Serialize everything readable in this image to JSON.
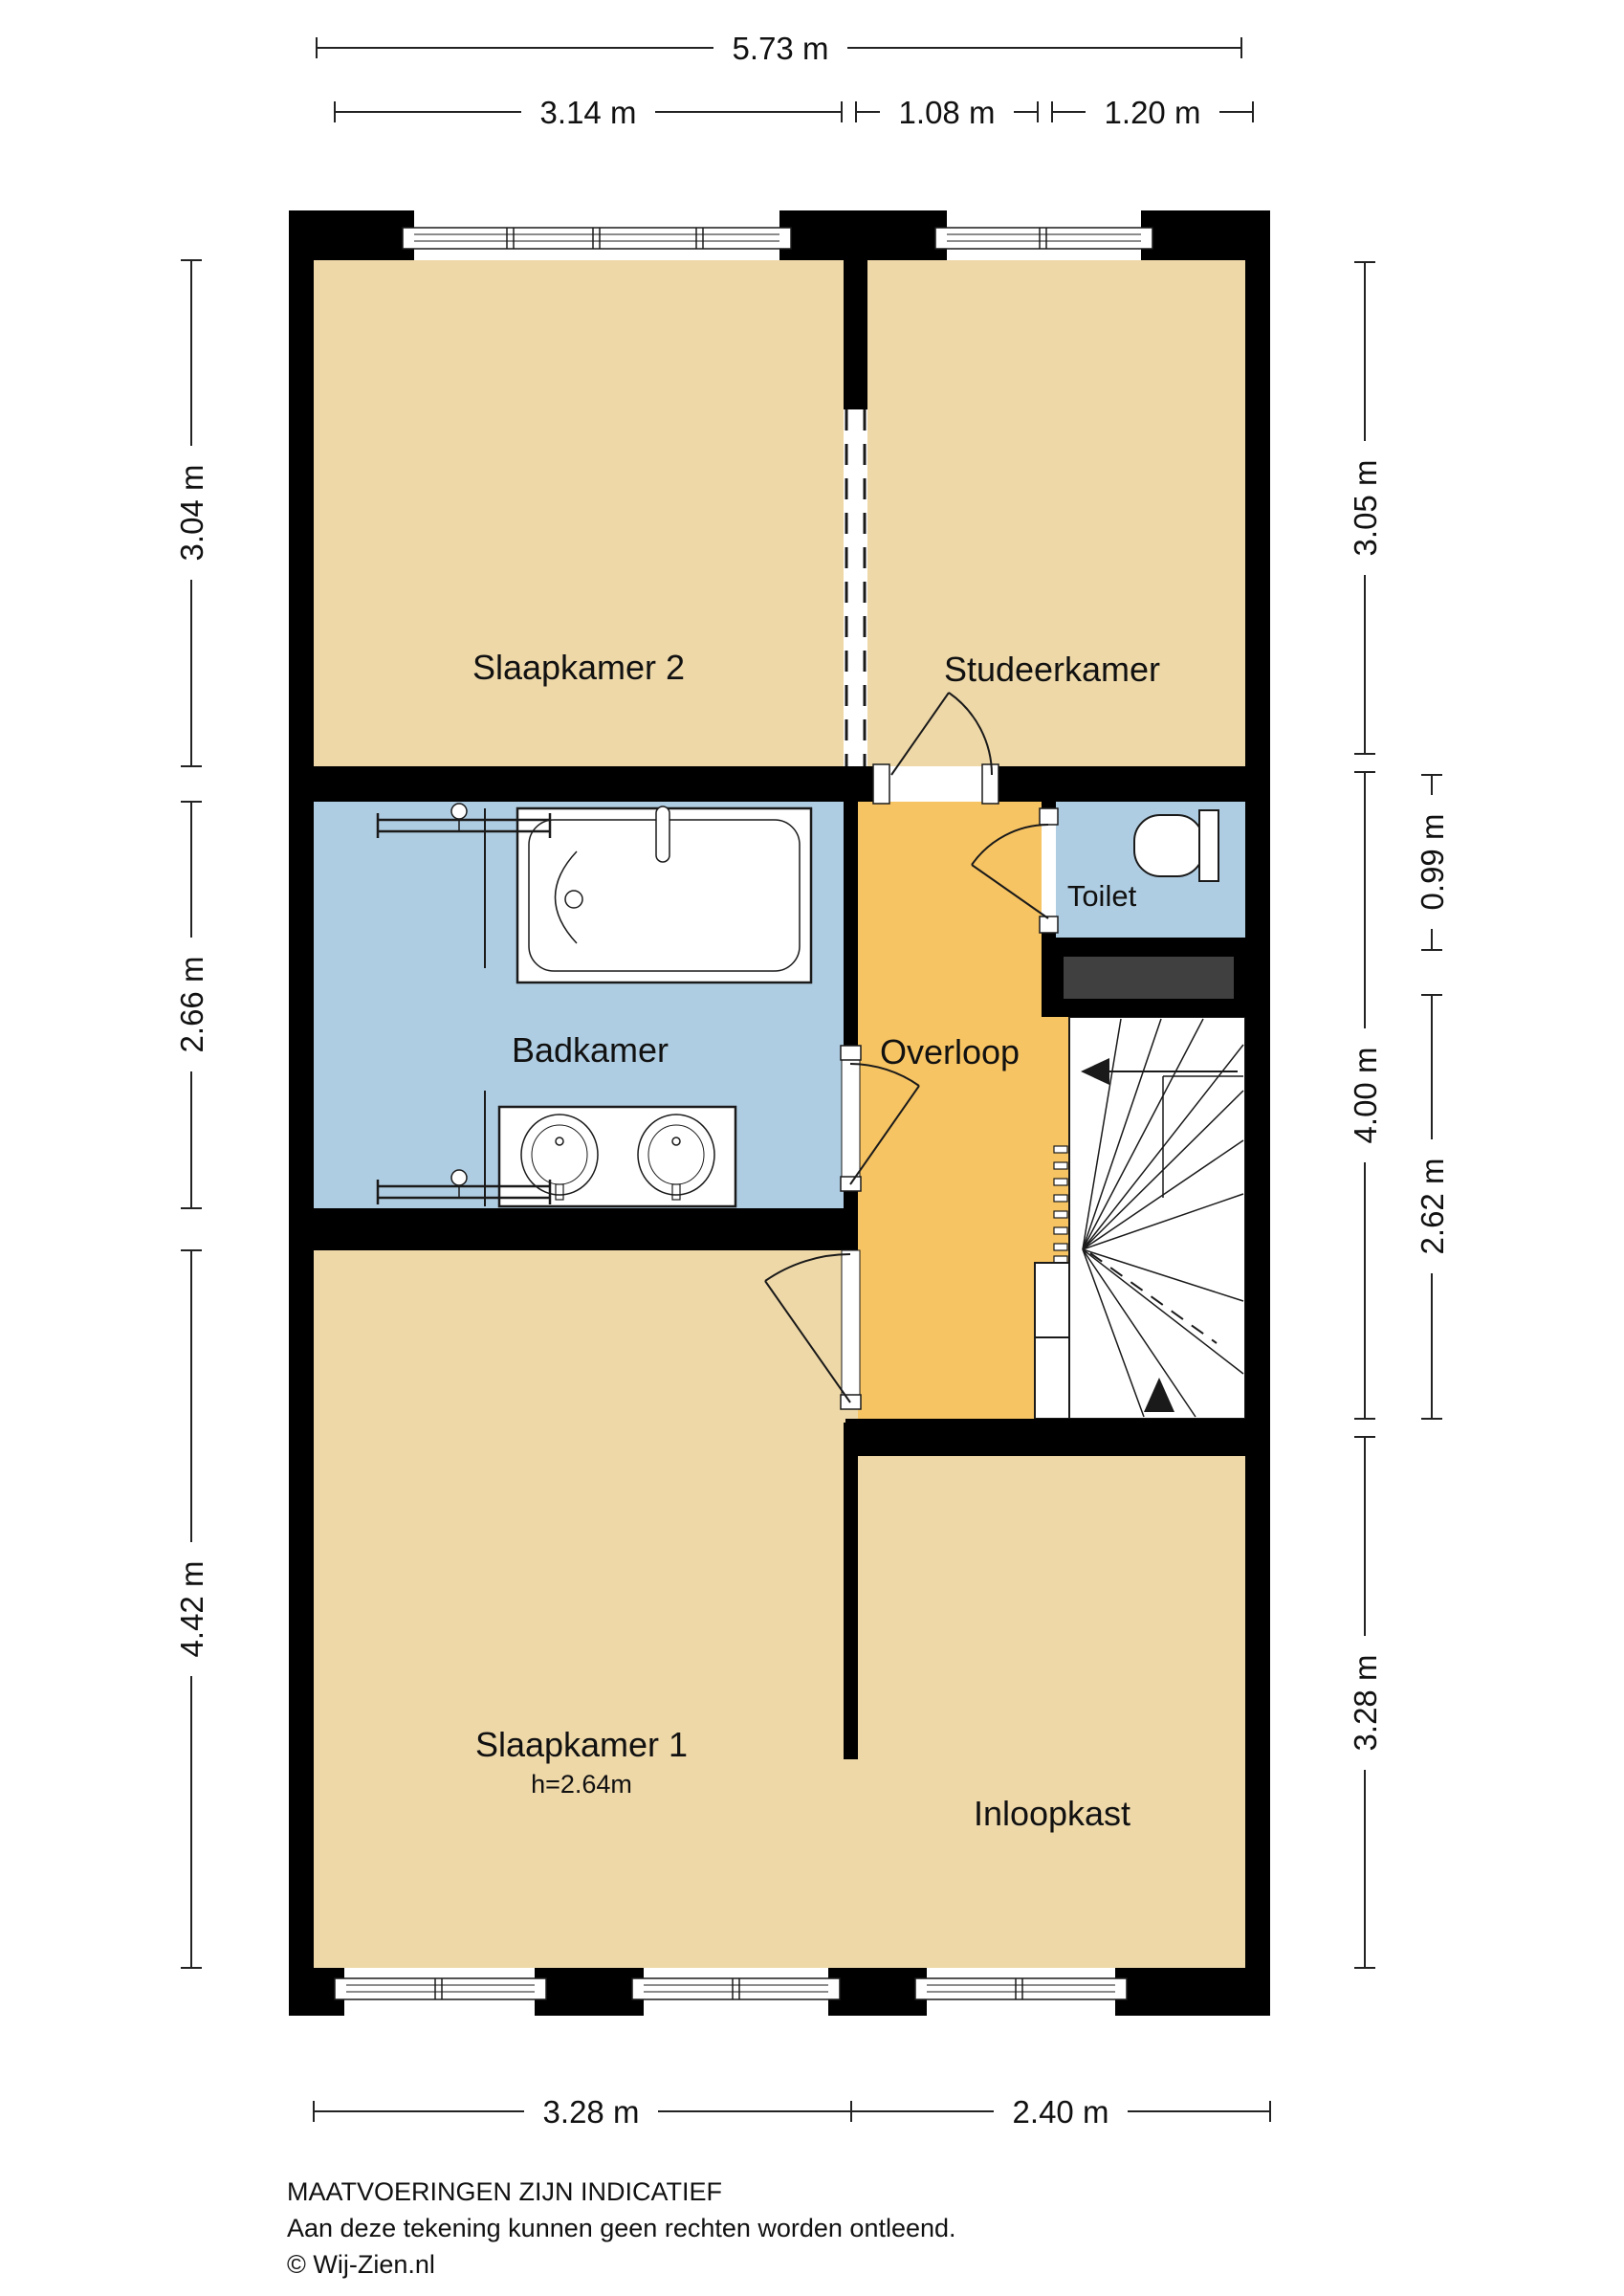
{
  "plan_title": "Floorplan first floor",
  "colors": {
    "wall": "#000000",
    "floor": "#EED8A8",
    "hallway": "#F7C463",
    "wet_room": "#AFCDE2",
    "shaft": "#404040",
    "line": "#1a1a1a",
    "white": "#FFFFFF"
  },
  "rooms": {
    "slaapkamer2": {
      "label": "Slaapkamer 2"
    },
    "studeerkamer": {
      "label": "Studeerkamer"
    },
    "badkamer": {
      "label": "Badkamer"
    },
    "toilet": {
      "label": "Toilet"
    },
    "overloop": {
      "label": "Overloop"
    },
    "slaapkamer1": {
      "label": "Slaapkamer 1",
      "height_note": "h=2.64m"
    },
    "inloopkast": {
      "label": "Inloopkast"
    }
  },
  "dimensions": {
    "top_total": "5.73 m",
    "top_segments": [
      "3.14 m",
      "1.08 m",
      "1.20 m"
    ],
    "left": [
      "3.04 m",
      "2.66 m",
      "4.42 m"
    ],
    "right_outer": [
      "3.05 m",
      "4.00 m",
      "3.28 m"
    ],
    "right_inner": [
      "0.99 m",
      "2.62 m"
    ],
    "bottom": [
      "3.28 m",
      "2.40 m"
    ]
  },
  "footer": {
    "disclaimer_title": "MAATVOERINGEN ZIJN INDICATIEF",
    "disclaimer_text": "Aan deze tekening kunnen geen rechten worden ontleend.",
    "copyright": "© Wij-Zien.nl"
  }
}
